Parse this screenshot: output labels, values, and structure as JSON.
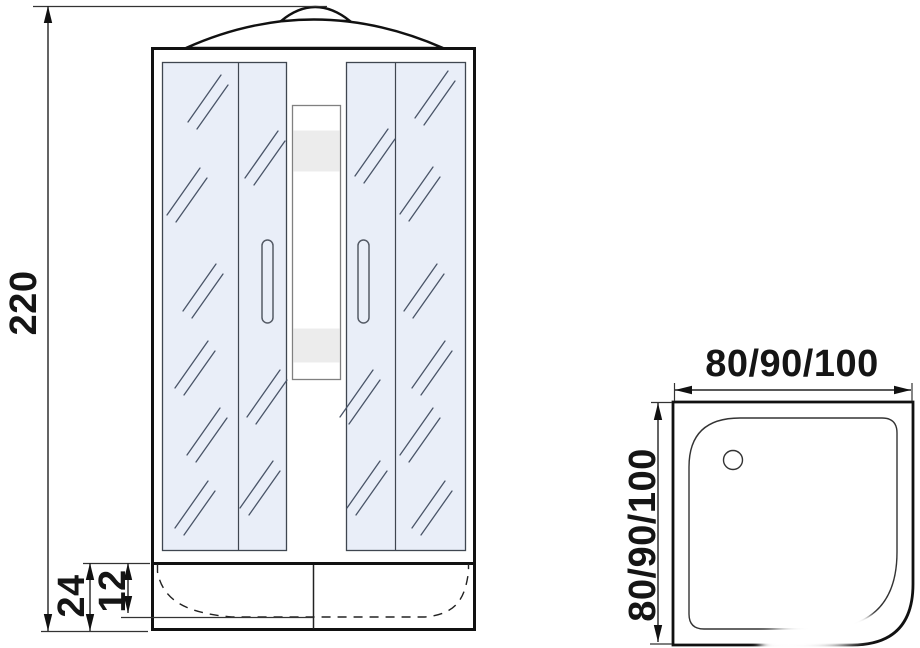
{
  "views": {
    "front": {
      "dim_height": "220",
      "dim_tray_height": "24",
      "dim_basin_depth": "12"
    },
    "top": {
      "dim_width": "80/90/100",
      "dim_depth": "80/90/100"
    }
  },
  "colors": {
    "glass": "#e9eef8",
    "shelf_band": "#ececec",
    "line": "#111111",
    "hatch": "#4a5568",
    "background": "#ffffff"
  }
}
